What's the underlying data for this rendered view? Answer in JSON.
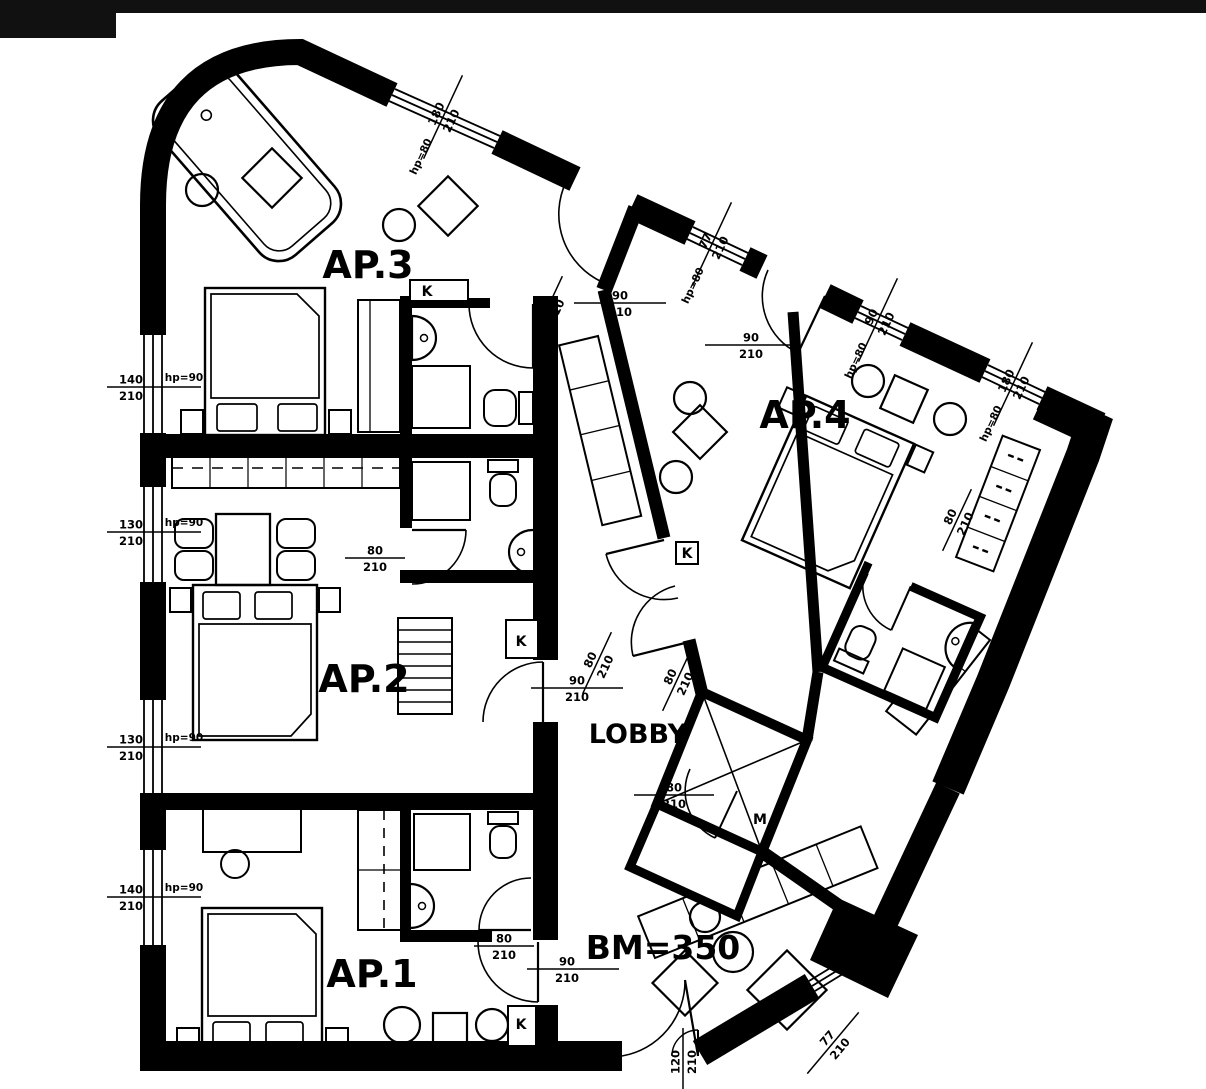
{
  "drawing": {
    "type": "architectural-floor-plan",
    "units_note": "dimensions shown as width/height in cm",
    "ink_color": "#000000",
    "background_color": "#ffffff"
  },
  "rooms": [
    {
      "id": "ap3",
      "label": "AP.3",
      "x": 368,
      "y": 278,
      "size": 38
    },
    {
      "id": "ap2",
      "label": "AP.2",
      "x": 364,
      "y": 692,
      "size": 38
    },
    {
      "id": "ap1",
      "label": "AP.1",
      "x": 372,
      "y": 987,
      "size": 38
    },
    {
      "id": "ap4",
      "label": "AP.4",
      "x": 805,
      "y": 428,
      "size": 38
    },
    {
      "id": "lobby",
      "label": "LOBBY",
      "x": 638,
      "y": 743,
      "size": 27
    },
    {
      "id": "bm",
      "label": "BM=350",
      "x": 663,
      "y": 959,
      "size": 33
    }
  ],
  "markers": [
    {
      "id": "k-ap3",
      "label": "K",
      "x": 427,
      "y": 296
    },
    {
      "id": "k-ap2",
      "label": "K",
      "x": 521,
      "y": 646
    },
    {
      "id": "k-corridor",
      "label": "K",
      "x": 687,
      "y": 558
    },
    {
      "id": "k-ap1",
      "label": "K",
      "x": 521,
      "y": 1029
    },
    {
      "id": "m-room",
      "label": "M",
      "x": 760,
      "y": 824
    }
  ],
  "dimensions": [
    {
      "id": "win-left-1",
      "num": "140",
      "den": "210",
      "x": 131,
      "y": 387,
      "rot": 0,
      "l1": -24,
      "l2": 70
    },
    {
      "id": "win-left-2",
      "num": "130",
      "den": "210",
      "x": 131,
      "y": 532,
      "rot": 0,
      "l1": -24,
      "l2": 70
    },
    {
      "id": "win-left-3",
      "num": "130",
      "den": "210",
      "x": 131,
      "y": 747,
      "rot": 0,
      "l1": -24,
      "l2": 70
    },
    {
      "id": "win-left-4",
      "num": "140",
      "den": "210",
      "x": 131,
      "y": 897,
      "rot": 0,
      "l1": -24,
      "l2": 70
    },
    {
      "id": "win-top-1",
      "num": "180",
      "den": "210",
      "x": 443,
      "y": 117,
      "rot": -65,
      "l1": -46,
      "l2": 46
    },
    {
      "id": "win-top-2",
      "num": "77",
      "den": "210",
      "x": 712,
      "y": 244,
      "rot": -65,
      "l1": -46,
      "l2": 46
    },
    {
      "id": "win-top-3",
      "num": "90",
      "den": "210",
      "x": 878,
      "y": 320,
      "rot": -65,
      "l1": -46,
      "l2": 46
    },
    {
      "id": "win-top-4",
      "num": "180",
      "den": "210",
      "x": 1013,
      "y": 384,
      "rot": -65,
      "l1": -46,
      "l2": 46
    },
    {
      "id": "door-ap3",
      "num": "90",
      "den": "210",
      "x": 620,
      "y": 303,
      "rot": 0,
      "l1": -46,
      "l2": 46
    },
    {
      "id": "door-ap3-bath",
      "num": "80",
      "den": "210",
      "x": 548,
      "y": 307,
      "rot": -65,
      "l1": -34,
      "l2": 34
    },
    {
      "id": "door-ap4",
      "num": "90",
      "den": "210",
      "x": 751,
      "y": 345,
      "rot": 0,
      "l1": -46,
      "l2": 46
    },
    {
      "id": "door-ap2",
      "num": "90",
      "den": "210",
      "x": 577,
      "y": 688,
      "rot": 0,
      "l1": -46,
      "l2": 46
    },
    {
      "id": "door-corridor-1",
      "num": "80",
      "den": "210",
      "x": 597,
      "y": 663,
      "rot": -65,
      "l1": -34,
      "l2": 34
    },
    {
      "id": "door-corridor-2",
      "num": "80",
      "den": "210",
      "x": 677,
      "y": 680,
      "rot": -65,
      "l1": -34,
      "l2": 34
    },
    {
      "id": "door-m-room",
      "num": "80",
      "den": "210",
      "x": 674,
      "y": 795,
      "rot": 0,
      "l1": -40,
      "l2": 40
    },
    {
      "id": "door-ap1",
      "num": "90",
      "den": "210",
      "x": 567,
      "y": 969,
      "rot": 0,
      "l1": -40,
      "l2": 52
    },
    {
      "id": "door-ap1-bath",
      "num": "80",
      "den": "210",
      "x": 504,
      "y": 946,
      "rot": 0,
      "l1": -30,
      "l2": 30
    },
    {
      "id": "door-ap2-bath",
      "num": "80",
      "den": "210",
      "x": 375,
      "y": 558,
      "rot": 0,
      "l1": -30,
      "l2": 30
    },
    {
      "id": "door-ap4-bath",
      "num": "80",
      "den": "210",
      "x": 957,
      "y": 520,
      "rot": -65,
      "l1": -34,
      "l2": 34
    },
    {
      "id": "door-entry",
      "num": "120",
      "den": "210",
      "x": 683,
      "y": 1062,
      "rot": -90,
      "l1": -34,
      "l2": 34
    },
    {
      "id": "win-se",
      "num": "77",
      "den": "210",
      "x": 833,
      "y": 1043,
      "rot": -50,
      "l1": -40,
      "l2": 40
    }
  ],
  "hp_labels": [
    {
      "id": "hp-left-1",
      "text": "hp=90",
      "x": 184,
      "y": 381,
      "rot": 0
    },
    {
      "id": "hp-left-2",
      "text": "hp=90",
      "x": 184,
      "y": 526,
      "rot": 0
    },
    {
      "id": "hp-left-3",
      "text": "hp=90",
      "x": 184,
      "y": 741,
      "rot": 0
    },
    {
      "id": "hp-left-4",
      "text": "hp=90",
      "x": 184,
      "y": 891,
      "rot": 0
    },
    {
      "id": "hp-top-1",
      "text": "hp=80",
      "x": 424,
      "y": 158,
      "rot": -65
    },
    {
      "id": "hp-top-2",
      "text": "hp=80",
      "x": 696,
      "y": 287,
      "rot": -65
    },
    {
      "id": "hp-top-3",
      "text": "hp=80",
      "x": 859,
      "y": 362,
      "rot": -65
    },
    {
      "id": "hp-top-4",
      "text": "hp=80",
      "x": 994,
      "y": 425,
      "rot": -65
    },
    {
      "id": "hp-se",
      "text": "hp=90",
      "x": 793,
      "y": 998,
      "rot": -50
    }
  ]
}
